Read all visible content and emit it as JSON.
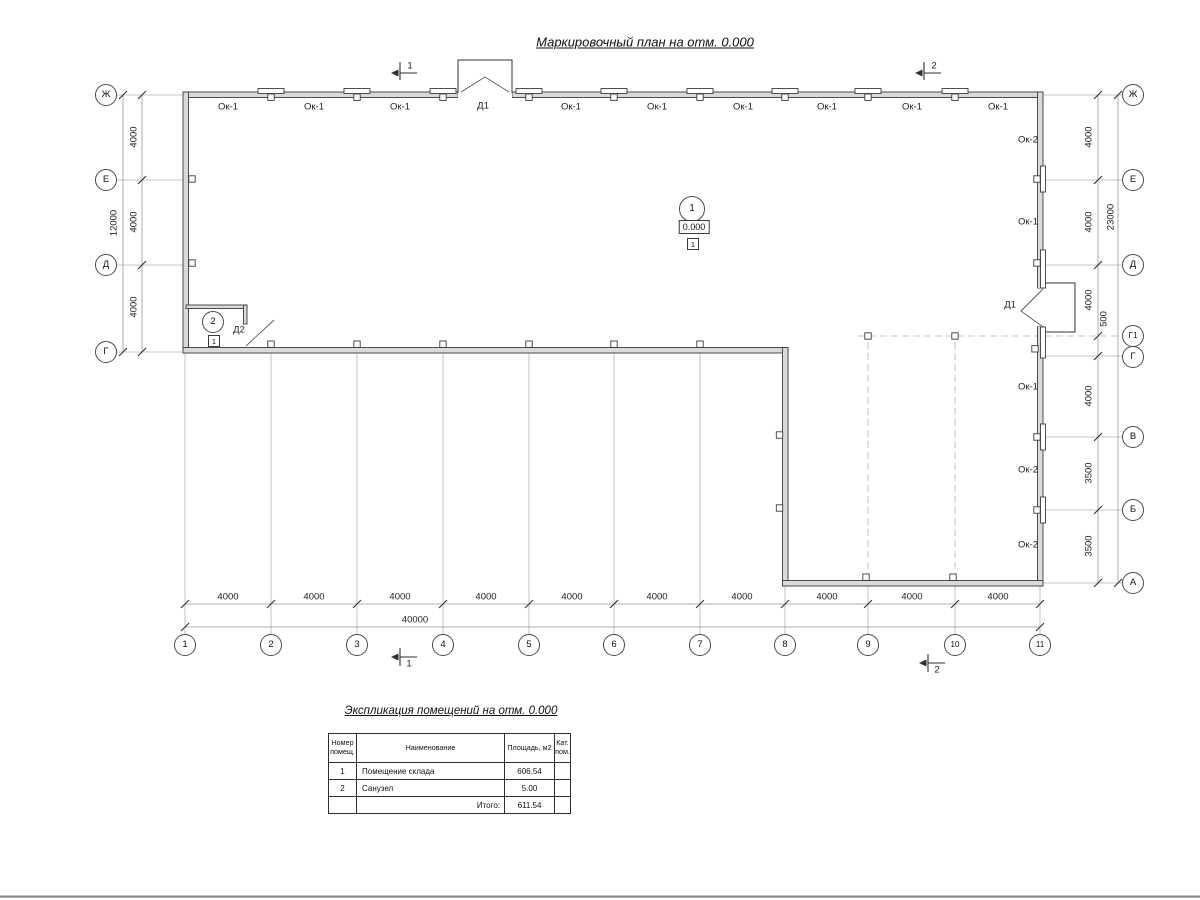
{
  "title": "Маркировочный план на отм. 0.000",
  "colors": {
    "wall_fill": "#dadada",
    "outline": "#3c3c3c",
    "grid": "#b4b4b4",
    "dim_line": "#979797"
  },
  "plan": {
    "top_labels": [
      "Ок-1",
      "Ок-1",
      "Ок-1",
      "Д1",
      "Ок-1",
      "Ок-1",
      "Ок-1",
      "Ок-1",
      "Ок-1",
      "Ок-1"
    ],
    "right_labels": [
      "Ок-2",
      "Ок-1",
      "Д1",
      "Ок-1",
      "Ок-2",
      "Ок-2"
    ],
    "axes_bottom": [
      "1",
      "2",
      "3",
      "4",
      "5",
      "6",
      "7",
      "8",
      "9",
      "10",
      "11"
    ],
    "axes_left": [
      "Ж",
      "Е",
      "Д",
      "Г"
    ],
    "axes_right": [
      "Ж",
      "Е",
      "Д",
      "Г1",
      "Г",
      "В",
      "Б",
      "А"
    ],
    "dims_bottom_bays": [
      "4000",
      "4000",
      "4000",
      "4000",
      "4000",
      "4000",
      "4000",
      "4000",
      "4000",
      "4000"
    ],
    "dim_bottom_total": "40000",
    "dims_left": [
      "4000",
      "4000",
      "4000"
    ],
    "dim_left_total": "12000",
    "dims_right_upper": [
      "4000",
      "4000",
      "4000",
      "500"
    ],
    "dims_right_lower": [
      "4000",
      "3500",
      "3500"
    ],
    "dim_right_total": "23000",
    "section_marks": [
      "1",
      "2"
    ],
    "room1": {
      "number": "1",
      "elevation": "0.000",
      "floor_type": "1"
    },
    "room2": {
      "number": "2",
      "floor_type": "1",
      "door_label": "Д2"
    }
  },
  "table": {
    "title": "Экспликация помещений на отм. 0.000",
    "headers": {
      "num": "Номер помещ.",
      "name": "Наименование",
      "area": "Площадь, м2",
      "cat": "Кат. пом."
    },
    "rows": [
      {
        "num": "1",
        "name": "Помещение склада",
        "area": "606.54",
        "cat": ""
      },
      {
        "num": "2",
        "name": "Санузел",
        "area": "5.00",
        "cat": ""
      }
    ],
    "total_label": "Итого:",
    "total_value": "611.54"
  }
}
